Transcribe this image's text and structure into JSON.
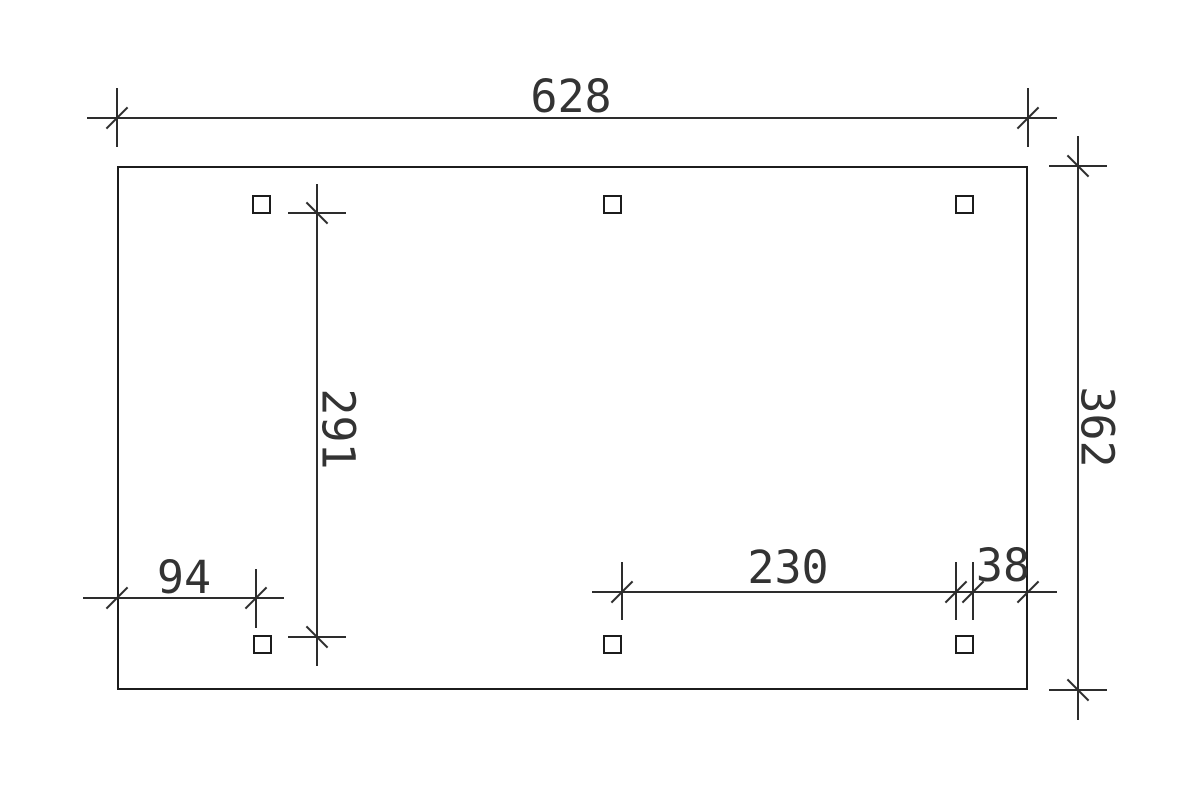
{
  "drawing": {
    "kind": "carport foundation plan / dimension drawing",
    "background": "#ffffff",
    "ink_color": "#2d2d2d",
    "dimensions": {
      "top_width": "628",
      "right_height": "362",
      "post_axis_height": "291",
      "bottom_left_offset": "94",
      "bottom_post_spacing": "230",
      "bottom_right_offset": "38"
    },
    "posts_count": 6
  }
}
